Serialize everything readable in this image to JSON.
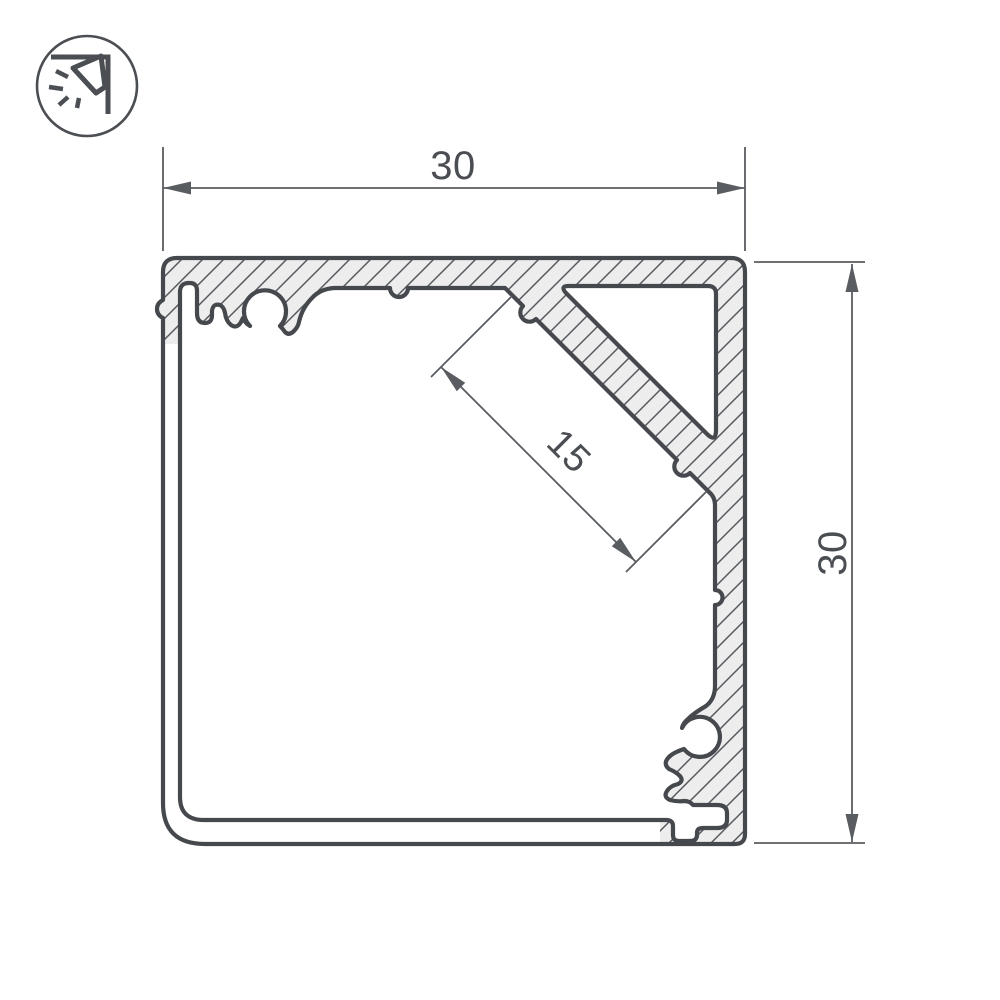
{
  "page": {
    "background": "#ffffff"
  },
  "logo": {
    "icon": "corner-light-icon",
    "description": "circled corner-mounted luminaire pictogram"
  },
  "drawing": {
    "subject": "aluminium corner LED profile cross-section",
    "dimensions": {
      "width": {
        "value": "30"
      },
      "height": {
        "value": "30"
      },
      "shelf": {
        "value": "15"
      }
    },
    "colors": {
      "outline": "#45484c",
      "metal_fill": "#ededee",
      "hatch": "#55585c",
      "dimension_lines": "#595c60",
      "dimension_text": "#4a4d52"
    }
  }
}
